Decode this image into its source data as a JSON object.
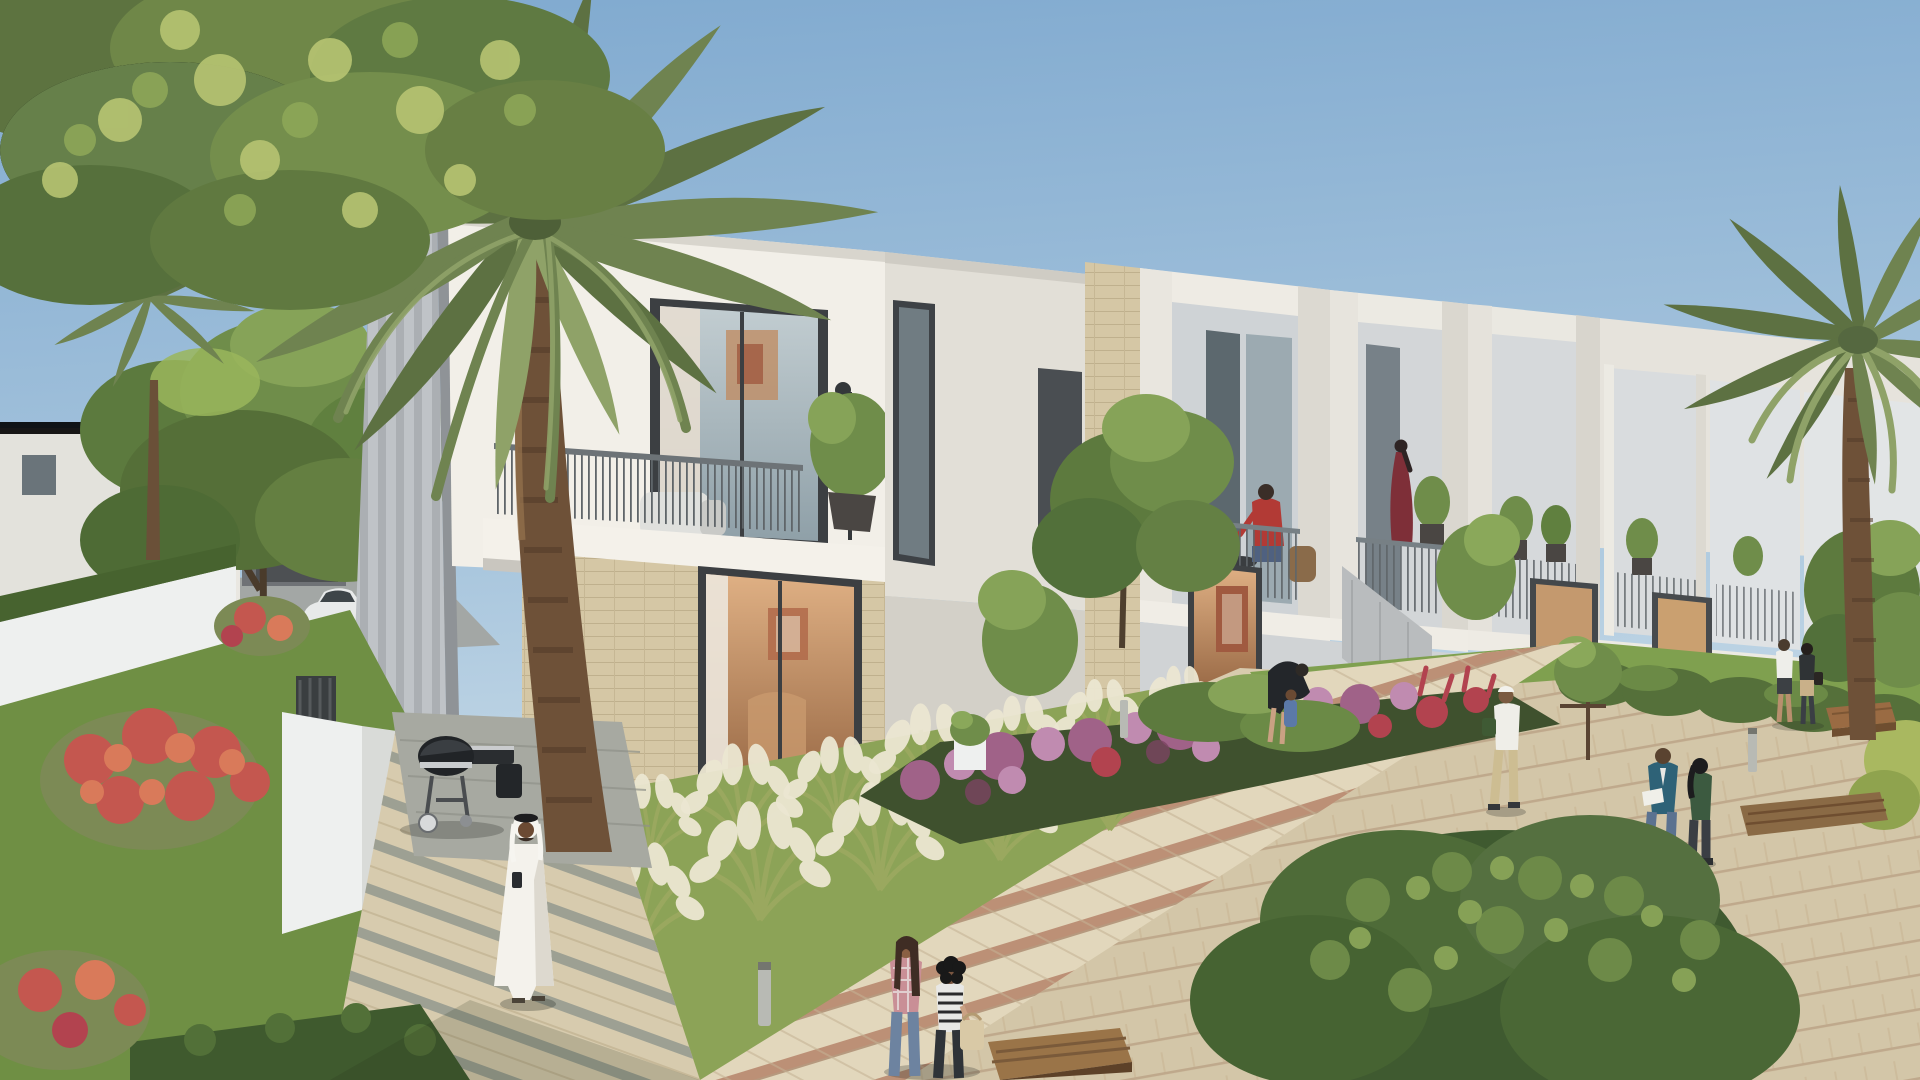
{
  "scene": {
    "type": "architectural-rendering",
    "subject": "modern two-storey townhouse community with landscaped walkways, gardens, palm trees and residents",
    "time_of_day": "late-afternoon daylight",
    "sky": {
      "top": "#7fa9cf",
      "mid": "#aac7de",
      "horizon": "#dce8ee"
    },
    "palette": {
      "building_white": "#eae7e0",
      "building_bright": "#f2efe8",
      "building_shade": "#c6c9cc",
      "building_dark": "#a8acb0",
      "pillar_stripe_a": "#b3b7bb",
      "pillar_stripe_b": "#c3c7cb",
      "stone": "#d5c7a5",
      "stone_line": "#bfb08d",
      "window_frame": "#3c3f42",
      "glass_cool": "#aeb9bd",
      "glass_dark": "#5c686e",
      "interior_warm": "#c08a5e",
      "interior_deep": "#8a5a38",
      "curtain": "#e5ddd0",
      "art_red": "#a05a40",
      "railing": "#5f6569",
      "palm_trunk": "#6e5138",
      "palm_trunk_dark": "#54猫3c2a",
      "frond_dark": "#5d7142",
      "frond_mid": "#6f8350",
      "frond_light": "#8fa268",
      "leaf_highlight": "#b7c472",
      "tree_green": "#6f8d4a",
      "tree_dark": "#506b36",
      "lawn": "#7fa04f",
      "lawn_bright": "#9ab65c",
      "hedge": "#47632f",
      "flower_purple": "#a06288",
      "flower_pink": "#c08bb0",
      "flower_crimson": "#b2434f",
      "flower_red": "#c4574f",
      "flower_orange": "#d97a5a",
      "plume": "#ece7d2",
      "grass_blade": "#9aa85f",
      "paver": "#d8cbae",
      "paver_light": "#e2d7bc",
      "paver_band": "#b5846a",
      "stone_band": "#979b90",
      "street": "#a3a7a5",
      "bench_wood": "#9a6b43",
      "bench_dark": "#6f4e30",
      "grill_black": "#212427",
      "metal_silver": "#c9ccce",
      "car_white": "#e8eaea",
      "kandura_white": "#f4f2ec",
      "skin": "#8a6044",
      "skin_dark": "#6b4a33"
    },
    "buildings": {
      "main_row": "row of seven attached townhouse units receding to the right, white render with beige stone cladding, box-framed balconies, dark window frames",
      "background_left": "two background villas and a dark grey garage block behind garden trees",
      "features": [
        "corner pillar with vertical ribs",
        "stone-clad entrance pillars",
        "balcony planter trees",
        "warm lit interiors with wall art",
        "privacy partition walls",
        "louvred utility enclosure"
      ]
    },
    "vegetation": [
      "giant foreground date palm",
      "right-edge date palm",
      "small distant palm left",
      "large leafy tree top-left",
      "garden tree over background villas",
      "ornamental fountain grasses with cream plumes",
      "purple and crimson flower bed",
      "red poinciana bushes",
      "clipped hedges",
      "lawn strips",
      "large foreground shrub bottom-right"
    ],
    "objects": [
      {
        "name": "white-sedan",
        "color": "#e8eaea"
      },
      {
        "name": "kettle-bbq-grill-cart",
        "color": "#212427"
      },
      {
        "name": "wooden-bench",
        "count": 4,
        "color": "#9a6b43"
      },
      {
        "name": "light-bollard",
        "count": 3,
        "color": "#b8bab4"
      },
      {
        "name": "white-planter",
        "count": 2,
        "color": "#eef0ef"
      },
      {
        "name": "garden-walls",
        "color": "#eef0ef"
      }
    ],
    "people": [
      {
        "name": "man-in-white-kandura",
        "detail": "walking on left path holding phone, white ghutra headdress"
      },
      {
        "name": "woman-in-abaya-with-two-children",
        "detail": "walking near parked car, background left"
      },
      {
        "name": "man-red-shirt-balcony",
        "detail": "seated at balcony table, unit three"
      },
      {
        "name": "woman-maroon-dress-balcony",
        "detail": "standing on recessed balcony, unit four"
      },
      {
        "name": "parent-and-child-garden",
        "detail": "dark top adult bending toward child in blue"
      },
      {
        "name": "man-white-shirt-cap",
        "detail": "walking on right path carrying plant"
      },
      {
        "name": "distant-couple",
        "detail": "walking away on right path"
      },
      {
        "name": "couple-blue-jacket-green-top",
        "detail": "walking toward viewer reading a paper"
      },
      {
        "name": "two-women-foreground",
        "detail": "plaid shirt and striped top, walking on main walkway"
      }
    ]
  }
}
